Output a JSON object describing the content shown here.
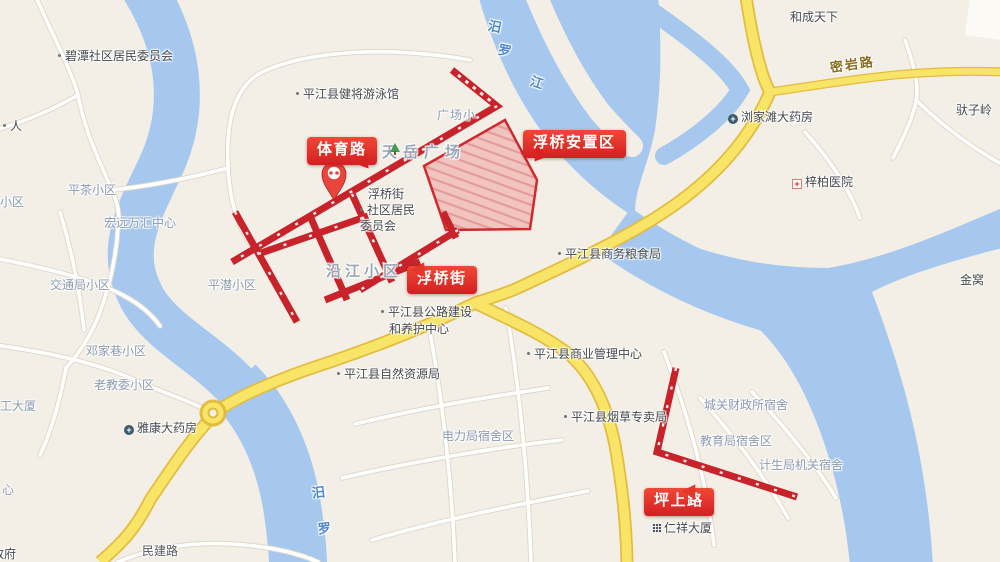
{
  "map": {
    "callouts": {
      "tiyu_road": "体育路",
      "fuqiao_zone": "浮桥安置区",
      "fuqiao_street": "浮桥街",
      "pingshang_road": "坪上路"
    },
    "labels": [
      {
        "text": "碧潭社区居民委员会"
      },
      {
        "text": "平江县健将游泳馆"
      },
      {
        "text": "和成天下"
      },
      {
        "text": "驮子岭"
      },
      {
        "text": "浏家滩大药房",
        "icon": "pharmacy-icon"
      },
      {
        "text": "梓柏医院",
        "icon": "hospital-icon"
      },
      {
        "text": "金窝"
      },
      {
        "text": "平江县商务粮食局"
      },
      {
        "text": "平江县商业管理中心"
      },
      {
        "text": "平江县自然资源局"
      },
      {
        "text": "平江县烟草专卖局"
      },
      {
        "text": "平江县公路建设"
      },
      {
        "text": "和养护中心"
      },
      {
        "text": "浮桥街"
      },
      {
        "text": "社区居民"
      },
      {
        "text": "委员会"
      },
      {
        "text": "电力局宿舍区"
      },
      {
        "text": "城关财政所宿舍"
      },
      {
        "text": "教育局宿舍区"
      },
      {
        "text": "计生局机关宿舍"
      },
      {
        "text": "仁祥大厦",
        "icon": "building-icon"
      },
      {
        "text": "民建路"
      },
      {
        "text": "平茶小区"
      },
      {
        "text": "宏远万汇中心"
      },
      {
        "text": "交通局小区"
      },
      {
        "text": "平潜小区"
      },
      {
        "text": "邓家巷小区"
      },
      {
        "text": "老教委小区"
      },
      {
        "text": "雅康大药房",
        "icon": "pharmacy-icon"
      },
      {
        "text": "工大厦"
      },
      {
        "text": "心"
      },
      {
        "text": "政府"
      },
      {
        "text": "人"
      },
      {
        "text": "小区"
      },
      {
        "text": "天岳广场"
      },
      {
        "text": "沿江小区"
      },
      {
        "text": "广场小"
      },
      {
        "text": "密岩路"
      },
      {
        "text": "汨"
      },
      {
        "text": "罗"
      },
      {
        "text": "江"
      },
      {
        "text": "汨"
      },
      {
        "text": "罗"
      },
      {
        "text": "",
        "icon": "tree-icon"
      }
    ],
    "colors": {
      "land": "#f3efe6",
      "water": "#a6c8ef",
      "road_yellow": "#f8e568",
      "road_yellow_casing": "#e3bc3f",
      "overlay_red": "#c8232b",
      "callout_red": "#e13228",
      "zone_fill": "#f0b9b6",
      "zone_border": "#d02a2e"
    }
  }
}
